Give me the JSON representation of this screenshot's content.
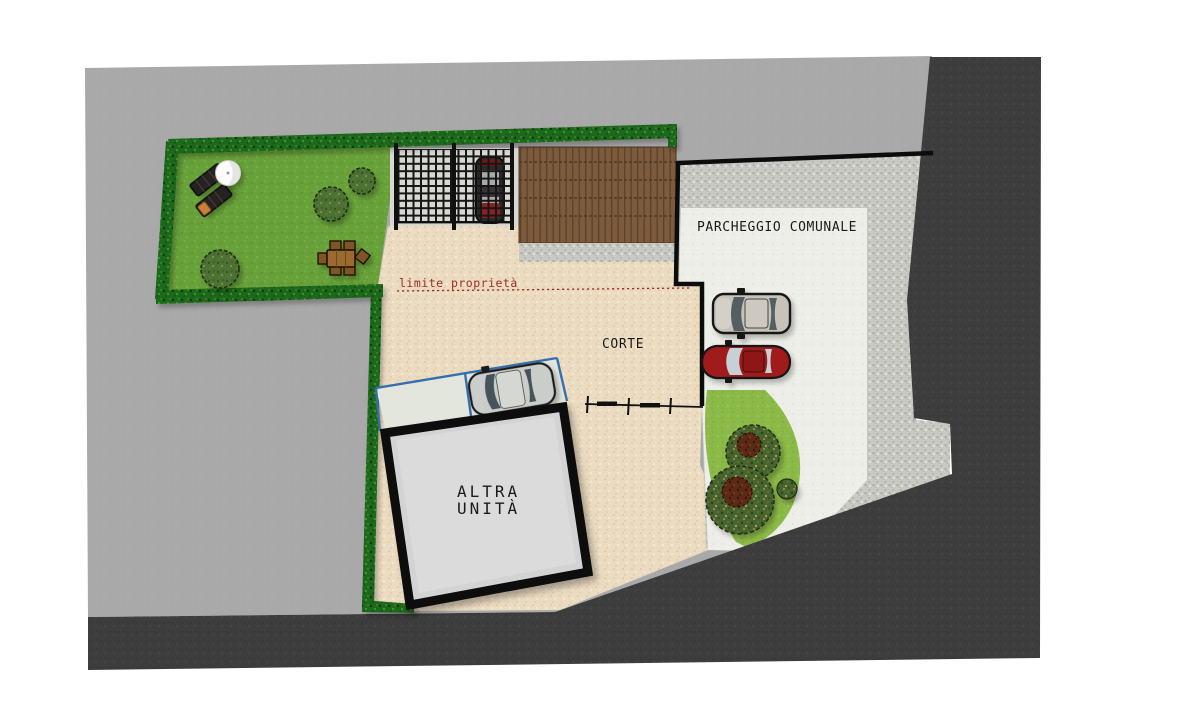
{
  "plan": {
    "labels": {
      "parking_area": "PARCHEGGIO COMUNALE",
      "property_limit": "limite proprietà",
      "courtyard": "CORTE",
      "other_unit_line1": "ALTRA",
      "other_unit_line2": "UNITÀ"
    },
    "palette": {
      "ink": "#1a1a1a",
      "limit_red": "#9e2b25",
      "stall_blue": "#366fae",
      "building_gray": "#d3d3d3",
      "plan_gray": "#a9a9a9",
      "road_dark": "#3d3d3d",
      "courtyard_beige": "#ebdbc1",
      "lawn_green": "#68a13a",
      "hedge_green": "#1f671d",
      "deck_brown": "#7b5a3d",
      "parking_surface": "#edeee8",
      "gravel_gray": "#c9c9c4",
      "car_red": "#a01b1f",
      "car_silver": "#cacecb",
      "car_gray": "#c7c3b8"
    }
  }
}
